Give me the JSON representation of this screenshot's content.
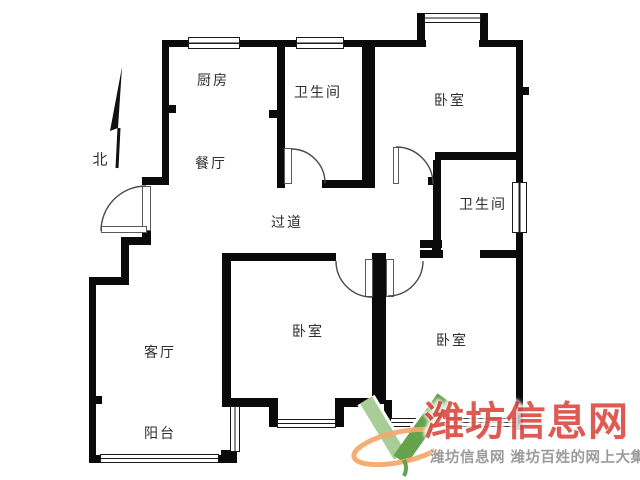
{
  "floor_plan": {
    "rooms": [
      {
        "id": "kitchen",
        "label": "厨房"
      },
      {
        "id": "bathroom-1",
        "label": "卫生间"
      },
      {
        "id": "bedroom-1",
        "label": "卧室"
      },
      {
        "id": "dining",
        "label": "餐厅"
      },
      {
        "id": "hallway",
        "label": "过道"
      },
      {
        "id": "bathroom-2",
        "label": "卫生间"
      },
      {
        "id": "living",
        "label": "客厅"
      },
      {
        "id": "bedroom-2",
        "label": "卧室"
      },
      {
        "id": "bedroom-3",
        "label": "卧室"
      },
      {
        "id": "balcony",
        "label": "阳台"
      }
    ],
    "north_label": "北",
    "colors": {
      "wall": "#0a0a0a",
      "label": "#2e2e2e"
    }
  },
  "watermark": {
    "site_name": "潍坊信息网",
    "tagline": "潍坊信息网 潍坊百姓的网上大集",
    "colors": {
      "site_name": "#dc4f46",
      "tagline": "#9b9b9b",
      "logo_green_light": "#a8cd96",
      "logo_green_dark": "#64a24c",
      "logo_orange": "#f3a96b"
    }
  }
}
